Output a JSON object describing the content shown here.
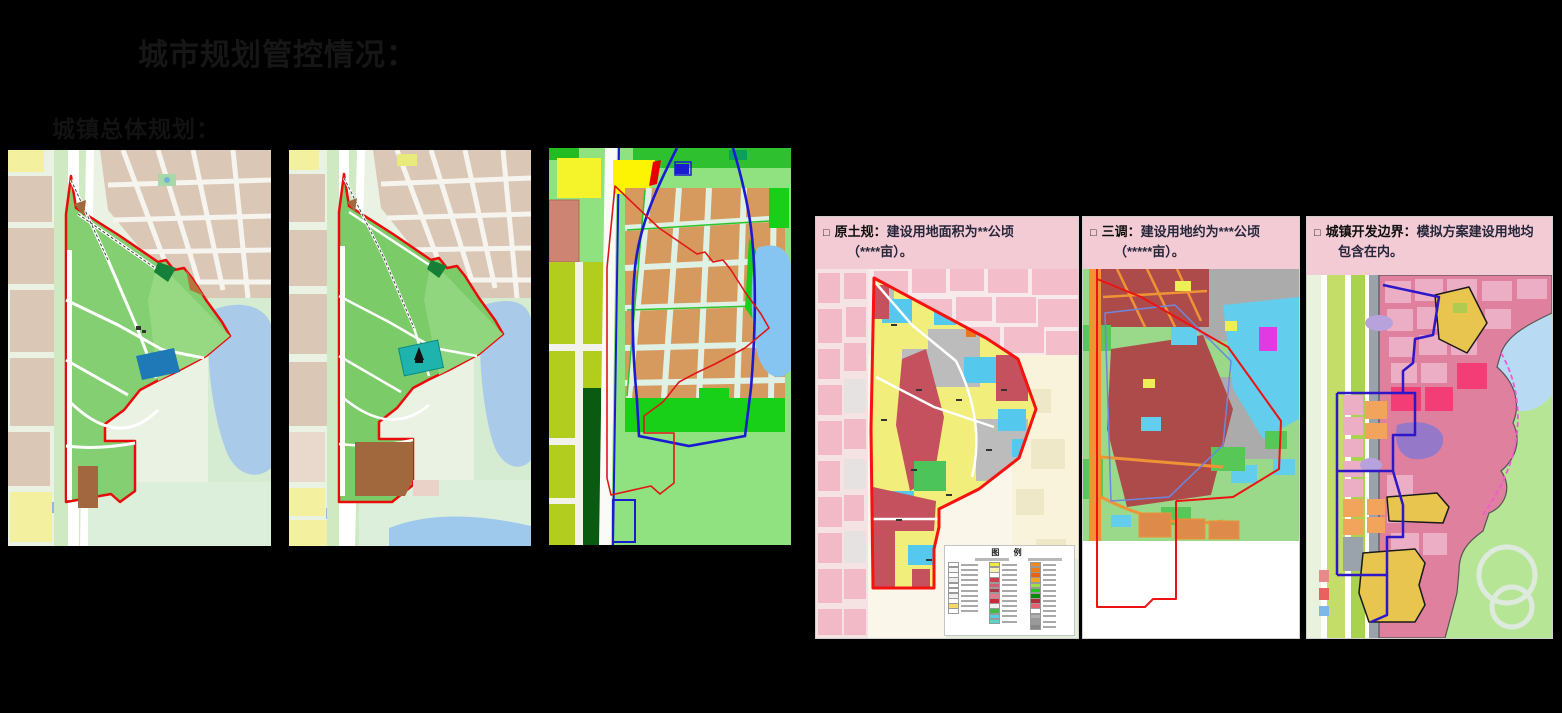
{
  "slide": {
    "title": "城市规划管控情况：",
    "subtitle": "城镇总体规划："
  },
  "callouts": {
    "original_plan": {
      "bullet": "□",
      "label": "原土规：",
      "text": "建设用地面积为**公顷",
      "text2": "（****亩）。"
    },
    "third_survey": {
      "bullet": "□",
      "label": "三调：",
      "text": "建设用地约为***公顷",
      "text2": "（*****亩）。"
    },
    "dev_boundary": {
      "bullet": "□",
      "label": "城镇开发边界：",
      "text": "模拟方案建设用地均",
      "text2": "包含在内。"
    }
  },
  "legend": {
    "title": "图  例",
    "columns": [
      {
        "chips": [
          "#ffffff",
          "#f8f8f8",
          "#ffffff",
          "#eeeeee",
          "#ffffff",
          "#ffffff",
          "#f2f2f2",
          "#ffffff",
          "#f5d76e",
          "#ffffff"
        ]
      },
      {
        "chips": [
          "#f2e93e",
          "#f8f4b0",
          "#ffffff",
          "#c9414f",
          "#d06070",
          "#b03745",
          "#e27b8a",
          "#cc2936",
          "#f0f0f0",
          "#44bb44",
          "#55cfe8",
          "#5ad4c9"
        ]
      },
      {
        "chips": [
          "#f0891e",
          "#ee7b13",
          "#e8650d",
          "#f2a51f",
          "#9ae23f",
          "#23c523",
          "#0a8a0a",
          "#b52d3c",
          "#ea5f72",
          "#ffffff",
          "#b0b0b0",
          "#999999",
          "#888888"
        ]
      }
    ]
  },
  "colors": {
    "background": "#000000",
    "title_text": "#161616",
    "callout_pink": "#f2cbd5",
    "site_boundary_red": "#ea0b0b",
    "boundary_blue": "#2d17c8",
    "site_green": "#84cf72",
    "water_blue": "#a9cae9"
  }
}
